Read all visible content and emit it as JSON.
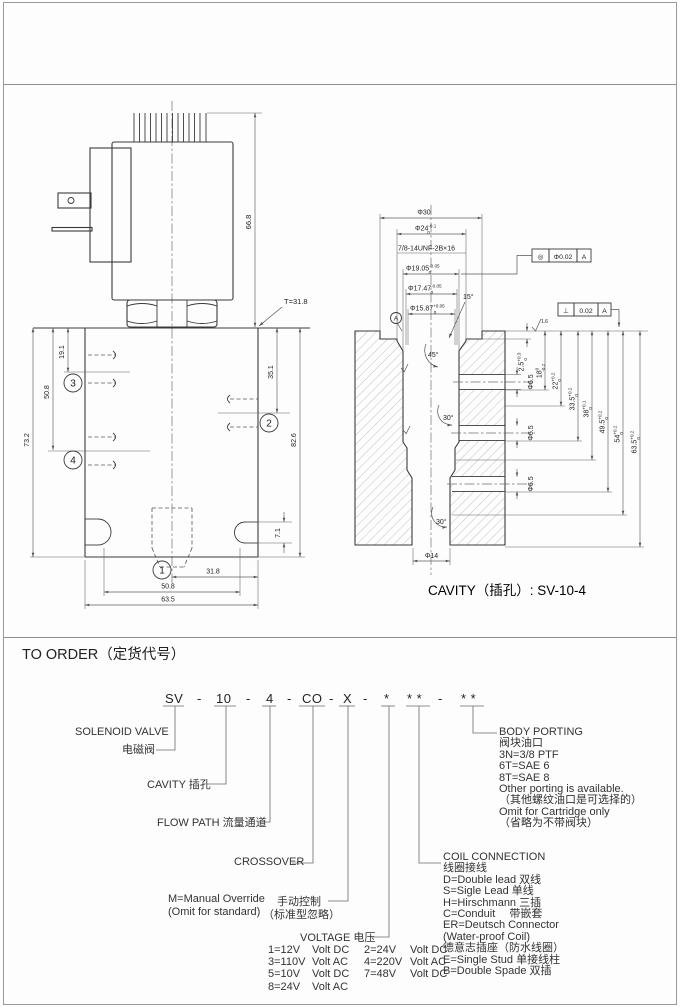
{
  "sheet": {
    "cavity_caption": "CAVITY（插孔）: SV-10-4"
  },
  "valve": {
    "dims": {
      "coil_height": "66.8",
      "tube": "T=31.8",
      "p3": "19.1",
      "p4": "50.8",
      "body_h": "73.2",
      "p2": "35.1",
      "overall": "82.6",
      "slot": "7.1",
      "b31_8": "31.8",
      "b50_8": "50.8",
      "b63_5": "63.5"
    },
    "balloons": {
      "n1": "1",
      "n2": "2",
      "n3": "3",
      "n4": "4"
    }
  },
  "cavity": {
    "thread": "7/8-14UNF-2B×16",
    "d30": "Φ30",
    "d24": {
      "v": "Φ24",
      "sup": "-0.1",
      "sub": "0"
    },
    "d1905": {
      "v": "Φ19.05",
      "sup": "-0.05",
      "sub": "0"
    },
    "d1747": {
      "v": "Φ17.47",
      "sup": "-0.05",
      "sub": "0"
    },
    "d1587": {
      "v": "Φ15.87",
      "sup": "+0.05",
      "sub": "0"
    },
    "a15": "15°",
    "a45": "45°",
    "a30a": "30°",
    "a30b": "30°",
    "s25": {
      "v": "2.5",
      "sup": "+0.3",
      "sub": "0"
    },
    "s18": {
      "v": "18",
      "sup": "0",
      "sub": "-0.2"
    },
    "s22": {
      "v": "22",
      "sup": "+0.2",
      "sub": "0"
    },
    "s335": {
      "v": "33.5",
      "sup": "+0.2",
      "sub": "0"
    },
    "s38": {
      "v": "38",
      "sup": "+0.1",
      "sub": "0"
    },
    "s495": {
      "v": "49.5",
      "sup": "+0.2",
      "sub": "0"
    },
    "s54": {
      "v": "54",
      "sup": "+0.2",
      "sub": "0"
    },
    "s635": {
      "v": "63.5",
      "sup": "+0.2",
      "sub": "0"
    },
    "d65": "Φ6.5",
    "d14": "Φ14",
    "gdt": {
      "conc": "◎",
      "conc_tol": "Φ0.02",
      "perp": "⊥",
      "perp_tol": "0.02",
      "datum": "A",
      "rough": "1.6"
    }
  },
  "order": {
    "title": "TO ORDER（定货代号）",
    "dash": "-",
    "code": [
      "SV",
      "10",
      "4",
      "CO",
      "X",
      "*",
      "* *",
      "* *"
    ],
    "solenoid_en": "SOLENOID VALVE",
    "solenoid_zh": "电磁阀",
    "cavity_label": "CAVITY  插孔",
    "flow_path": "FLOW PATH  流量通道",
    "crossover": "CROSSOVER",
    "manual_en": "M=Manual Override",
    "manual_en2": "(Omit for standard)",
    "manual_zh": "手动控制",
    "manual_zh2": "（标准型忽略）",
    "voltage_label": "VOLTAGE  电压",
    "voltage_rows": [
      [
        "1=12V",
        "Volt DC",
        "2=24V",
        "Volt DC"
      ],
      [
        "3=110V",
        "Volt AC",
        "4=220V",
        "Volt AC"
      ],
      [
        "5=10V",
        "Volt DC",
        "7=48V",
        "Volt DC"
      ],
      [
        "8=24V",
        "Volt AC",
        "",
        ""
      ]
    ],
    "coil_title": "COIL CONNECTION",
    "coil_zh": "线圈接线",
    "coil_items": [
      "D=Double lead 双线",
      "S=Sigle Lead  单线",
      "H=Hirschmann  三插",
      "C=Conduit　 带嵌套",
      "ER=Deutsch Connector",
      "(Water-proof Coil)",
      "德意志插座（防水线圈）",
      "E=Single Stud  单接线柱",
      "B=Double Spade  双插"
    ],
    "porting_title": "BODY PORTING",
    "porting_zh": "阀块油口",
    "porting_items": [
      "3N=3/8  PTF",
      "6T=SAE  6",
      "8T=SAE  8",
      "Other porting is available.",
      "（其他螺纹油口是可选择的）",
      "Omit for Cartridge only",
      "（省略为不带阀块）"
    ]
  }
}
